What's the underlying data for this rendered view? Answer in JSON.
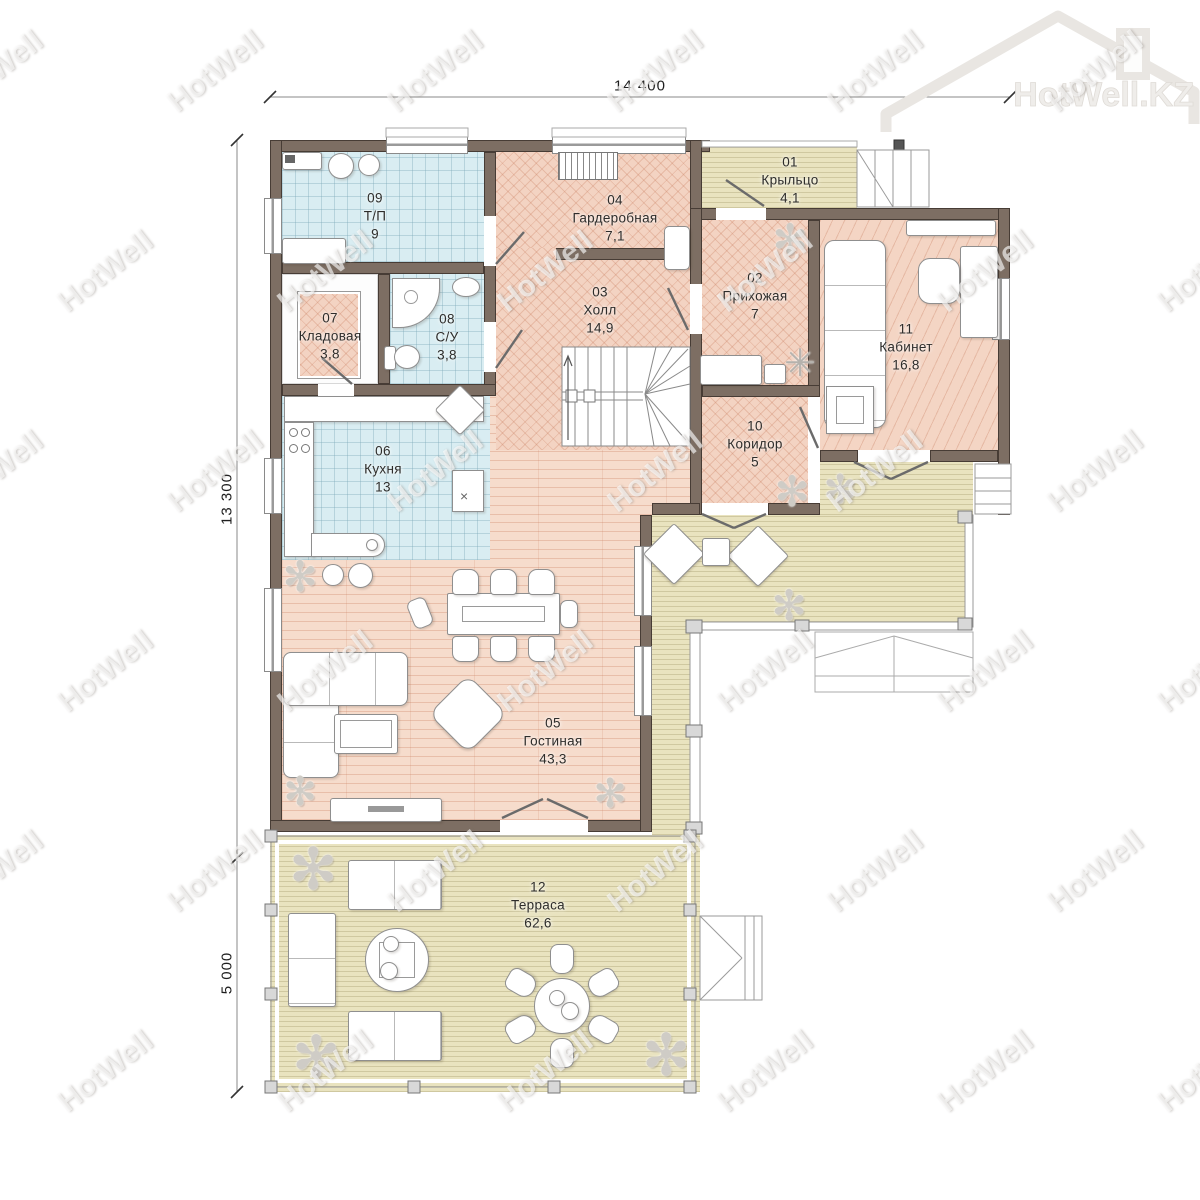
{
  "logo": {
    "text": "HotWell.KZ"
  },
  "watermark": {
    "text": "HotWell"
  },
  "dimensions": {
    "width_top": "14 400",
    "height_upper": "13 300",
    "height_lower": "5 000"
  },
  "icons": {
    "plant": "✻",
    "coat_rack": "✳",
    "sink_mark": "×"
  },
  "colors": {
    "wall": "#7d6e63",
    "tile_floor": "#d9edf2",
    "herringbone_floor": "#f3d3c2",
    "plank_floor": "#f6dccc",
    "deck_floor": "#e9e3bf"
  },
  "rooms": [
    {
      "number": "01",
      "name": "Крыльцо",
      "area": "4,1"
    },
    {
      "number": "02",
      "name": "Прихожая",
      "area": "7"
    },
    {
      "number": "03",
      "name": "Холл",
      "area": "14,9"
    },
    {
      "number": "04",
      "name": "Гардеробная",
      "area": "7,1"
    },
    {
      "number": "05",
      "name": "Гостиная",
      "area": "43,3"
    },
    {
      "number": "06",
      "name": "Кухня",
      "area": "13"
    },
    {
      "number": "07",
      "name": "Кладовая",
      "area": "3,8"
    },
    {
      "number": "08",
      "name": "С/У",
      "area": "3,8"
    },
    {
      "number": "09",
      "name": "Т/П",
      "area": "9"
    },
    {
      "number": "10",
      "name": "Коридор",
      "area": "5"
    },
    {
      "number": "11",
      "name": "Кабинет",
      "area": "16,8"
    },
    {
      "number": "12",
      "name": "Терраса",
      "area": "62,6"
    }
  ]
}
